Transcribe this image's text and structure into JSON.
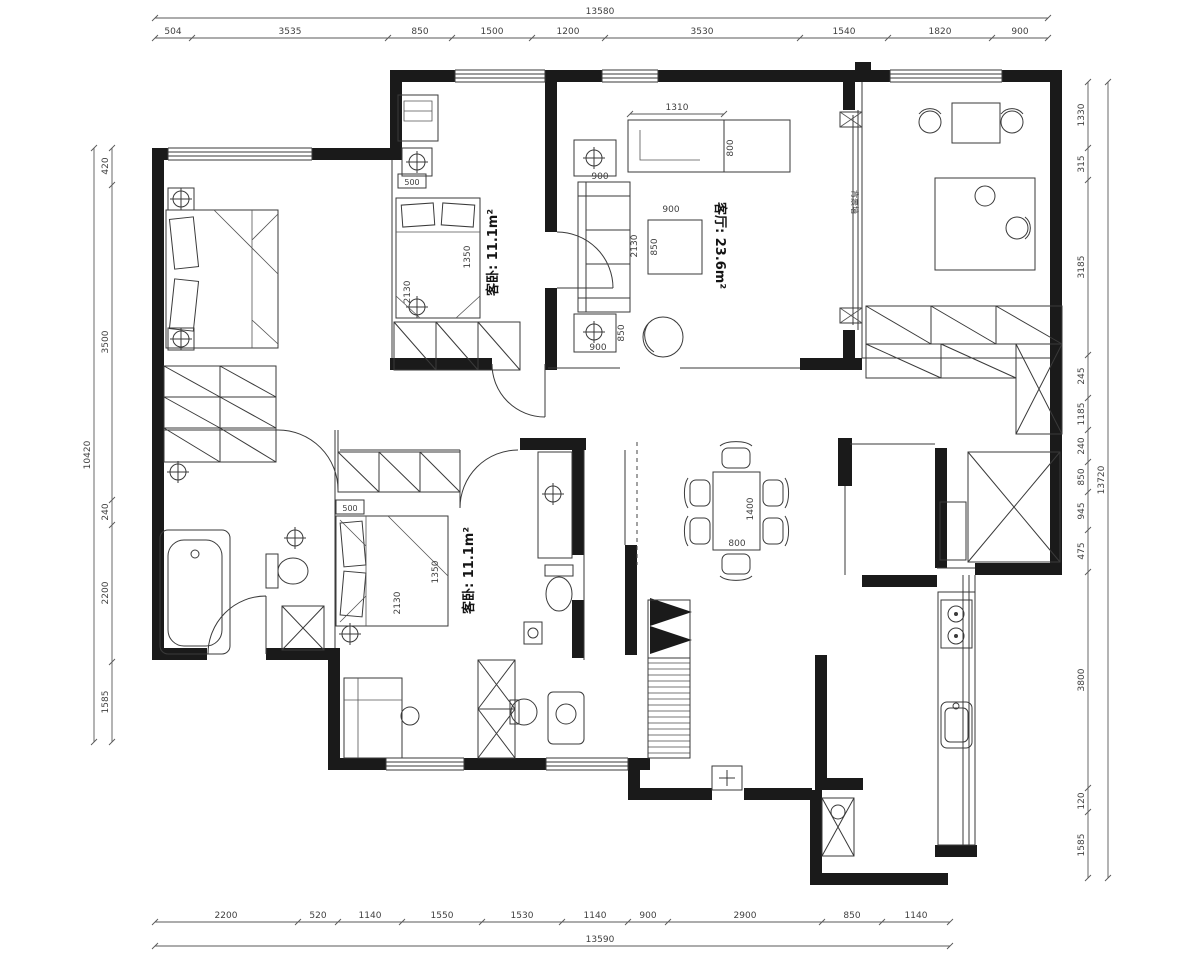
{
  "rooms": {
    "living": "客厅: 23.6m²",
    "bedroom_top": "客卧: 11.1m²",
    "bedroom_bottom": "客卧: 11.1m²",
    "tv_feature_wall": "背景墙"
  },
  "dims": {
    "top_total": "13580",
    "top": [
      "504",
      "3535",
      "850",
      "1500",
      "1200",
      "3530",
      "1540",
      "1820",
      "900"
    ],
    "bottom_total": "13590",
    "bottom": [
      "2200",
      "520",
      "1140",
      "1550",
      "1530",
      "1140",
      "900",
      "2900",
      "850",
      "1140"
    ],
    "left_total": "10420",
    "left": [
      "420",
      "3500",
      "240",
      "2200",
      "1585"
    ],
    "right_total": "13720",
    "right": [
      "1330",
      "315",
      "3185",
      "245",
      "1185",
      "240",
      "850",
      "945",
      "475",
      "3800",
      "120",
      "1585"
    ]
  },
  "interior_dims": {
    "tv_width": "1310",
    "tv_depth": "800",
    "sofa_width": "900",
    "sofa_length": "2130",
    "coffee_table_width": "900",
    "coffee_table_depth": "850",
    "speaker_depth": "850",
    "speaker_width": "900",
    "dining_length": "1400",
    "dining_width": "800",
    "bed2_box": "500",
    "bed2_width": "1350",
    "bed2_length": "2130",
    "bed3_box": "500",
    "bed3_width": "1350",
    "bed3_length": "2130"
  }
}
